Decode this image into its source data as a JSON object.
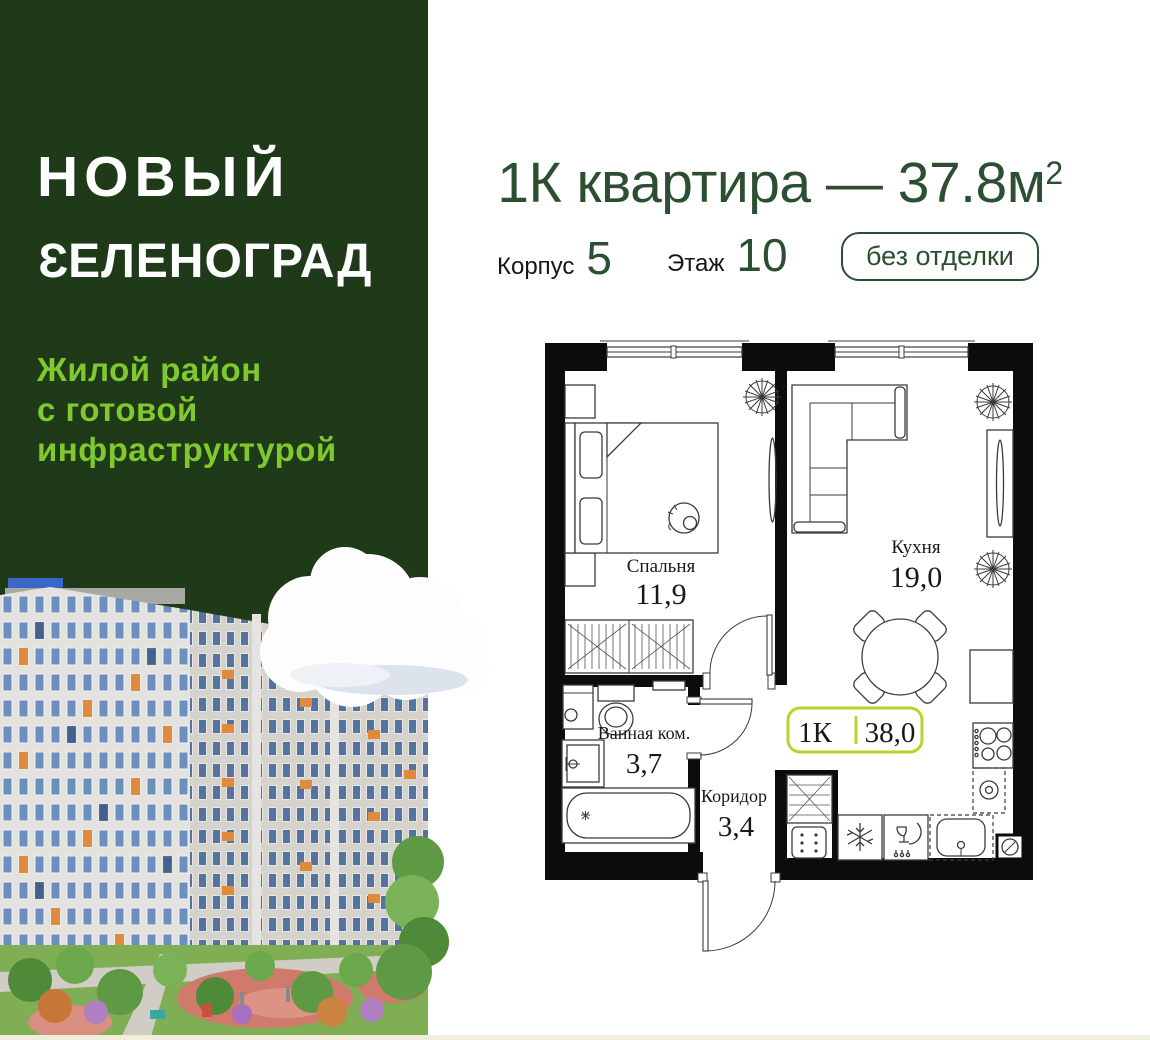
{
  "brand": {
    "line1": "НОВЫЙ",
    "line2_first": "З",
    "line2_rest": "ЕЛЕНОГРАД",
    "tagline": [
      "Жилой район",
      "с готовой",
      "инфраструктурой"
    ]
  },
  "header": {
    "title_main": "1К квартира — 37.8м",
    "title_sup": "2",
    "blocks": [
      {
        "label": "Корпус",
        "value": "5"
      },
      {
        "label": "Этаж",
        "value": "10"
      }
    ],
    "finish_badge": "без отделки"
  },
  "plan": {
    "badge": {
      "rooms_type": "1К",
      "total_area": "38,0"
    },
    "rooms": [
      {
        "name": "Спальня",
        "area": "11,9"
      },
      {
        "name": "Кухня",
        "area": "19,0"
      },
      {
        "name": "Ванная ком.",
        "area": "3,7"
      },
      {
        "name": "Коридор",
        "area": "3,4"
      }
    ]
  },
  "colors": {
    "panel_green": "#1e3a18",
    "heading_green": "#2d4f31",
    "lime": "#7fc82e",
    "plan_badge_lime": "#bcd02e"
  },
  "icons": {
    "plant": "plant-icon",
    "cat": "cat-icon",
    "snowflake": "fridge-snowflake-icon",
    "dishwasher": "dishwasher-icon",
    "stove": "stove-burners-icon",
    "oven": "oven-spiral-icon"
  }
}
